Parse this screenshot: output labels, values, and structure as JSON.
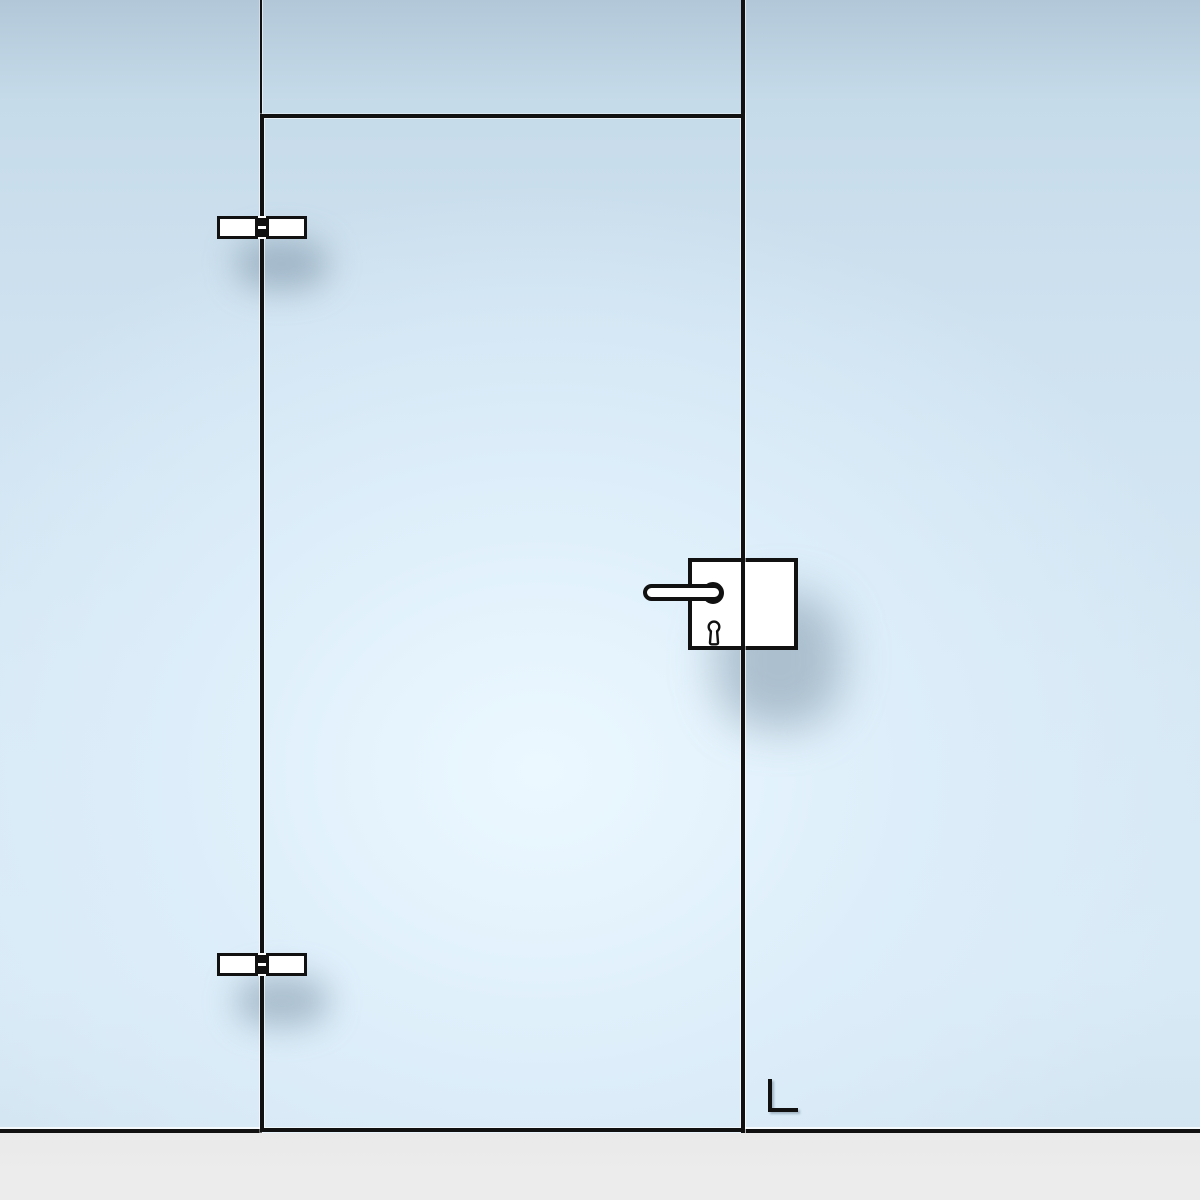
{
  "canvas": {
    "kind": "glass-door-technical-preview",
    "width_px": 1200,
    "height_px": 1200
  },
  "colors": {
    "line": "#111111",
    "fill": "#ffffff",
    "glass-light": "#ddeefa",
    "glass-dark": "#b2c8d8",
    "floor": "#ececec",
    "shadow": "rgba(106,130,151,0.45)"
  },
  "components": {
    "background": "glass-wall-with-side-panels-and-transom",
    "door_leaf": "hinged-glass-door-leaf",
    "hinge_top": "glass-door-clamp-hinge",
    "hinge_bottom": "glass-door-clamp-hinge",
    "lock_case": "glass-door-lock-case",
    "handle": "lever-handle-with-round-rose",
    "keyhole": "euro-profile-keyhole",
    "floor_marker": "corner-marker",
    "hinge_side": "left",
    "handle_side": "right"
  }
}
